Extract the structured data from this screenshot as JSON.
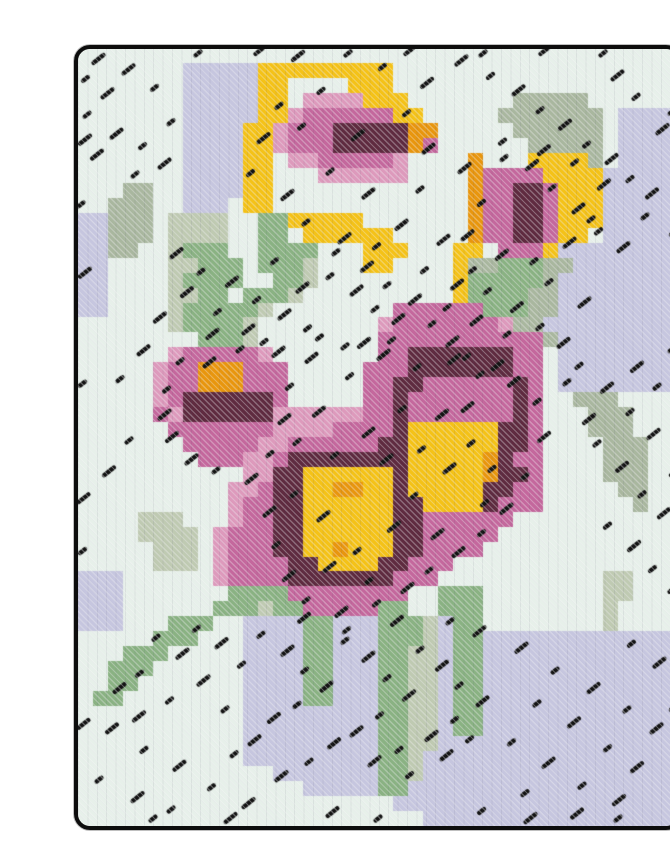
{
  "artwork": {
    "description": "Needlepoint cross-stitch artwork of pink pansy flowers with yellow and orange centers, yellow buds and green leaves on a pale mint and lavender stitched background with black accent stitches and a black rounded border",
    "page_background": "#ffffff",
    "border_color": "#0d0d0d",
    "frame": {
      "x": 38,
      "y": 33,
      "width": 600,
      "height": 777,
      "radius": 12
    },
    "grid": {
      "cols": 40,
      "rows": 52,
      "palette": {
        ".": "#e7f0ea",
        "l": "#c6c6df",
        "g": "#bfcab2",
        "d": "#a9b79f",
        "G": "#8ab283",
        "Y": "#f4c218",
        "O": "#e8960e",
        "m": "#dd9abc",
        "M": "#c4689d",
        "R": "#5f2b40"
      },
      "rows_data": [
        "........................................",
        ".......lllllYYYYYYYYY...................",
        ".......lllllYY....YYY...................",
        ".......lllllYY.mmmmYYY.......ddddd......",
        ".......lllllYYmMMMMMMYY.....ddddddd.llll",
        ".......llllYYmMMMRRRRROO.....dddddd.llll",
        ".......llllYYmMMMRRRRROM......ddddd.llll",
        ".......llllYY.mmMMMMMm....O...YYYYd.llll",
        ".......llllYY...mmmmmm....OMMMMYYYYlllll",
        "...dd..llllYY.............OMMRRMYYYlllll",
        "..ddd..lll.YY.............OMMRRMYYYlllll",
        "llddd.gggg..GGYYYYY.......OMMRRMYYYlllll",
        "llddd.gggg..GG.YYYYYY.....OMMRRMYY.lllll",
        "lldd..gGGG..GGGG...YYY...YY.MMMYllllllll",
        "ll....ggGGG.GGGg...YY....YddGGGddlllllll",
        "ll....gGGGG..GGg.........YGGGGGdllllllll",
        "ll....ggGG.GGGg..........YGGGGddllllllll",
        "ll....gGGGGGg........MMMMMMGGGddllllllll",
        "......gGGGGg........mMMMMMMMmddlllllllll",
        "........GGGg........MMMMMMMMMMMdllllllll",
        "......mMMMMMm.......MMRRRRRRRMM.llllllll",
        ".....mMMOOOMMM.....MMMRRRRRRRMM.llllllll",
        ".....mMMOOOMMM.....MMRRMMMMMMRM.llllllll",
        ".....mMRRRRRRM.....MMRMMMMMMMRM..ddd....",
        ".....MmRRRRRRmmmmmmMMRMMMMMMMRM...ddd...",
        "......MMMMMMMmmmmMMMMRYYYYYYRRM...ddd...",
        ".......MMMMMmmMMMMMMRRYYYYYYRRM....ddd..",
        "........MMMmmMRRRRRRRRYYYYYORMM....ddd..",
        "...........mmRRYYYYYYRYYYYYORRM....ddd..",
        "..........mmMRRYYOOYYRYYYYYRRMM.....dd..",
        "..........mMMRRYYYYYYRRYYYYRMMM......d..",
        "....ggg...mMMRRYYYYYYRRMMMMMM...........",
        "....gggg.mMMMRRYYYYYYRRMMMMM............",
        ".....ggg.mMMMRRYYOYYYRRMMMM.............",
        ".....ggg.mMMMMRRYYYYRRMMM...............",
        "lll......mMMMMRRRRRRRMMM...........gg...",
        "lll.......GGGGMMMMMMMM..GGG........gg...",
        "lll......GGGgGGMMMMMGG..GGG........g....",
        "lll...GGG..llllGGlllGGGglGG........g....",
        ".....GGG...llllGGlllGGGglGGlllllllllllll",
        "...GGG.....llllGGlllGGgglGGlllllllllllll",
        "..GGG......llllGGlllGGgglGGlllllllllllll",
        "..GG.......llllGGlllGGgglGGlllllllllllll",
        ".GG........llllGGlllGGgglGGlllllllllllll",
        "...........lllllllllGGgglGGlllllllllllll",
        "...........lllllllllGGgglGGlllllllllllll",
        "...........lllllllllGGggllllllllllllllll",
        "...........lllllllllGGglllllllllllllllll",
        ".............lllllllGGglllllllllllllllll",
        "...............lllllGGllllllllllllllllll",
        ".....................lllllllllllllllllll",
        ".......................lllllllllllllllll"
      ]
    },
    "speckles": {
      "color": "#141414",
      "length": 10.5,
      "width": 4.4,
      "angle_deg": -38,
      "points": [
        [
          8,
          0.3
        ],
        [
          12,
          0.2
        ],
        [
          18,
          0.3
        ],
        [
          22,
          0.2
        ],
        [
          27,
          0.3
        ],
        [
          31,
          0.2
        ],
        [
          35,
          0.3
        ],
        [
          1.2,
          0.8
        ],
        [
          0.5,
          2.0
        ],
        [
          1.8,
          3.1
        ],
        [
          0.6,
          4.4
        ],
        [
          3.2,
          1.5
        ],
        [
          5.1,
          2.6
        ],
        [
          2.4,
          5.8
        ],
        [
          4.3,
          6.5
        ],
        [
          1.1,
          7.2
        ],
        [
          6.2,
          4.9
        ],
        [
          5.6,
          7.8
        ],
        [
          3.8,
          8.4
        ],
        [
          14.5,
          0.6
        ],
        [
          20.3,
          1.2
        ],
        [
          23.1,
          2.4
        ],
        [
          16.2,
          2.8
        ],
        [
          25.4,
          0.9
        ],
        [
          27.5,
          1.8
        ],
        [
          29.2,
          2.9
        ],
        [
          30.8,
          4.1
        ],
        [
          32.3,
          5.2
        ],
        [
          33.9,
          6.4
        ],
        [
          35.4,
          7.5
        ],
        [
          36.8,
          8.7
        ],
        [
          38.1,
          9.8
        ],
        [
          28.3,
          6.2
        ],
        [
          30.1,
          7.9
        ],
        [
          31.6,
          9.3
        ],
        [
          33.2,
          10.8
        ],
        [
          34.7,
          12.2
        ],
        [
          36.2,
          13.4
        ],
        [
          37.8,
          11.2
        ],
        [
          38.8,
          5.5
        ],
        [
          37.2,
          3.2
        ],
        [
          35.8,
          1.9
        ],
        [
          13.4,
          3.8
        ],
        [
          12.2,
          6.1
        ],
        [
          11.5,
          8.3
        ],
        [
          13.8,
          9.9
        ],
        [
          15.2,
          11.6
        ],
        [
          17.6,
          12.8
        ],
        [
          19.9,
          13.2
        ],
        [
          21.4,
          11.9
        ],
        [
          22.8,
          9.4
        ],
        [
          23.2,
          6.8
        ],
        [
          21.9,
          4.3
        ],
        [
          18.5,
          5.9
        ],
        [
          16.8,
          8.2
        ],
        [
          19.2,
          9.8
        ],
        [
          14.9,
          5.2
        ],
        [
          25.6,
          8.1
        ],
        [
          26.9,
          10.3
        ],
        [
          25.8,
          12.6
        ],
        [
          26.3,
          14.8
        ],
        [
          28.1,
          13.9
        ],
        [
          30.4,
          14.2
        ],
        [
          32.6,
          13.1
        ],
        [
          34.2,
          11.4
        ],
        [
          34.9,
          9.2
        ],
        [
          33.1,
          7.6
        ],
        [
          30.9,
          6.9
        ],
        [
          28.4,
          7.3
        ],
        [
          25.1,
          15.9
        ],
        [
          24.6,
          17.3
        ],
        [
          6.4,
          13.8
        ],
        [
          8.2,
          14.9
        ],
        [
          10.1,
          15.7
        ],
        [
          11.9,
          16.8
        ],
        [
          13.6,
          17.9
        ],
        [
          15.3,
          18.7
        ],
        [
          7.1,
          16.4
        ],
        [
          9.3,
          17.6
        ],
        [
          11.2,
          18.9
        ],
        [
          16.8,
          15.2
        ],
        [
          18.4,
          16.3
        ],
        [
          19.8,
          17.4
        ],
        [
          21.2,
          18.2
        ],
        [
          17.2,
          13.6
        ],
        [
          19.1,
          14.7
        ],
        [
          20.6,
          15.8
        ],
        [
          5.3,
          18.1
        ],
        [
          13.1,
          14.2
        ],
        [
          14.8,
          16.1
        ],
        [
          16.1,
          19.3
        ],
        [
          18.9,
          19.8
        ],
        [
          12.4,
          19.6
        ],
        [
          8.8,
          19.2
        ],
        [
          20.9,
          19.5
        ],
        [
          22.3,
          16.9
        ],
        [
          23.6,
          18.4
        ],
        [
          24.8,
          19.7
        ],
        [
          23.1,
          14.8
        ],
        [
          24.2,
          12.9
        ],
        [
          27.3,
          16.2
        ],
        [
          29.1,
          17.4
        ],
        [
          30.8,
          18.6
        ],
        [
          32.2,
          19.8
        ],
        [
          28.6,
          19.1
        ],
        [
          26.4,
          18.3
        ],
        [
          31.4,
          15.6
        ],
        [
          33.6,
          17.1
        ],
        [
          25.9,
          20.6
        ],
        [
          27.8,
          21.3
        ],
        [
          33.4,
          21.2
        ],
        [
          35.1,
          22.8
        ],
        [
          36.8,
          24.3
        ],
        [
          38.2,
          25.9
        ],
        [
          34.6,
          26.4
        ],
        [
          36.1,
          28.1
        ],
        [
          37.6,
          29.8
        ],
        [
          38.9,
          31.2
        ],
        [
          35.3,
          31.9
        ],
        [
          36.9,
          33.4
        ],
        [
          38.3,
          34.8
        ],
        [
          33.9,
          24.9
        ],
        [
          32.6,
          22.3
        ],
        [
          37.1,
          21.4
        ],
        [
          38.6,
          22.6
        ],
        [
          4.2,
          20.3
        ],
        [
          2.8,
          22.1
        ],
        [
          5.6,
          24.6
        ],
        [
          3.4,
          26.2
        ],
        [
          1.9,
          28.4
        ],
        [
          6.8,
          20.9
        ],
        [
          13.2,
          20.4
        ],
        [
          14.1,
          22.6
        ],
        [
          13.6,
          24.9
        ],
        [
          12.8,
          27.1
        ],
        [
          11.4,
          28.9
        ],
        [
          9.2,
          28.2
        ],
        [
          7.4,
          27.6
        ],
        [
          5.9,
          22.8
        ],
        [
          8.6,
          21.1
        ],
        [
          10.8,
          20.1
        ],
        [
          6.1,
          26.1
        ],
        [
          14.6,
          26.3
        ],
        [
          15.4,
          20.8
        ],
        [
          17.8,
          19.9
        ],
        [
          20.2,
          20.6
        ],
        [
          22.6,
          21.3
        ],
        [
          24.9,
          20.9
        ],
        [
          26.8,
          21.8
        ],
        [
          28.9,
          22.4
        ],
        [
          30.6,
          23.6
        ],
        [
          30.9,
          26.1
        ],
        [
          29.8,
          28.6
        ],
        [
          28.4,
          30.9
        ],
        [
          26.9,
          32.4
        ],
        [
          25.2,
          33.8
        ],
        [
          23.4,
          34.9
        ],
        [
          21.8,
          36.2
        ],
        [
          19.9,
          37.1
        ],
        [
          17.4,
          37.8
        ],
        [
          15.2,
          36.9
        ],
        [
          13.9,
          35.4
        ],
        [
          13.2,
          33.2
        ],
        [
          12.6,
          31.1
        ],
        [
          14.4,
          29.8
        ],
        [
          16.2,
          31.4
        ],
        [
          18.6,
          33.6
        ],
        [
          20.9,
          32.1
        ],
        [
          22.4,
          29.9
        ],
        [
          24.6,
          28.2
        ],
        [
          26.2,
          26.4
        ],
        [
          24.1,
          24.6
        ],
        [
          21.6,
          24.1
        ],
        [
          19.2,
          25.8
        ],
        [
          17.1,
          27.2
        ],
        [
          15.9,
          24.4
        ],
        [
          18.1,
          21.9
        ],
        [
          20.4,
          27.6
        ],
        [
          22.9,
          26.8
        ],
        [
          25.8,
          24.1
        ],
        [
          27.6,
          28.1
        ],
        [
          16.6,
          34.8
        ],
        [
          19.4,
          35.6
        ],
        [
          23.8,
          32.6
        ],
        [
          27.1,
          30.4
        ],
        [
          14.9,
          38.2
        ],
        [
          17.9,
          38.9
        ],
        [
          21.1,
          38.4
        ],
        [
          5.2,
          39.4
        ],
        [
          6.8,
          40.6
        ],
        [
          4.1,
          41.8
        ],
        [
          2.6,
          42.9
        ],
        [
          7.9,
          38.8
        ],
        [
          9.4,
          39.9
        ],
        [
          10.9,
          41.2
        ],
        [
          8.2,
          42.4
        ],
        [
          6.1,
          43.6
        ],
        [
          3.9,
          44.8
        ],
        [
          12.2,
          39.2
        ],
        [
          13.8,
          40.4
        ],
        [
          15.1,
          41.6
        ],
        [
          16.4,
          42.8
        ],
        [
          14.6,
          43.9
        ],
        [
          12.9,
          44.9
        ],
        [
          17.8,
          39.6
        ],
        [
          19.2,
          40.8
        ],
        [
          20.6,
          42.1
        ],
        [
          21.9,
          43.4
        ],
        [
          20.1,
          44.6
        ],
        [
          18.4,
          45.8
        ],
        [
          22.8,
          40.2
        ],
        [
          24.1,
          41.4
        ],
        [
          25.4,
          42.6
        ],
        [
          26.8,
          43.8
        ],
        [
          25.1,
          44.9
        ],
        [
          23.4,
          46.1
        ],
        [
          21.4,
          46.9
        ],
        [
          19.6,
          47.8
        ],
        [
          22.1,
          48.6
        ],
        [
          24.4,
          47.4
        ],
        [
          26.1,
          46.2
        ],
        [
          16.9,
          46.6
        ],
        [
          15.4,
          47.7
        ],
        [
          26.6,
          39.1
        ],
        [
          24.8,
          38.3
        ],
        [
          11.6,
          46.4
        ],
        [
          9.8,
          44.2
        ],
        [
          29.4,
          40.2
        ],
        [
          31.8,
          41.6
        ],
        [
          34.2,
          42.9
        ],
        [
          36.6,
          44.2
        ],
        [
          38.4,
          45.6
        ],
        [
          30.6,
          43.8
        ],
        [
          32.9,
          45.2
        ],
        [
          35.3,
          46.8
        ],
        [
          37.1,
          48.2
        ],
        [
          28.9,
          46.4
        ],
        [
          31.2,
          47.9
        ],
        [
          33.6,
          49.3
        ],
        [
          35.9,
          50.4
        ],
        [
          29.8,
          49.8
        ],
        [
          38.6,
          41.2
        ],
        [
          36.9,
          39.8
        ],
        [
          2.1,
          45.6
        ],
        [
          4.4,
          46.9
        ],
        [
          6.6,
          48.1
        ],
        [
          1.4,
          48.9
        ],
        [
          3.8,
          50.2
        ],
        [
          8.9,
          49.4
        ],
        [
          11.2,
          50.6
        ],
        [
          6.2,
          50.9
        ],
        [
          13.4,
          48.8
        ],
        [
          10.4,
          47.2
        ],
        [
          16.8,
          51.2
        ],
        [
          26.9,
          51.0
        ],
        [
          33.1,
          51.3
        ],
        [
          5,
          51.5
        ],
        [
          10,
          51.6
        ],
        [
          20,
          51.5
        ],
        [
          30,
          51.6
        ],
        [
          36,
          51.5
        ],
        [
          0.3,
          6.2
        ],
        [
          0.2,
          10.4
        ],
        [
          0.3,
          15.1
        ],
        [
          0.3,
          22.4
        ],
        [
          0.2,
          30.2
        ],
        [
          0.3,
          33.6
        ],
        [
          0.2,
          45.3
        ],
        [
          39.6,
          4.2
        ],
        [
          39.7,
          12.3
        ],
        [
          39.6,
          20.1
        ],
        [
          39.7,
          28.4
        ],
        [
          39.6,
          36.2
        ],
        [
          39.7,
          44.1
        ]
      ]
    }
  }
}
